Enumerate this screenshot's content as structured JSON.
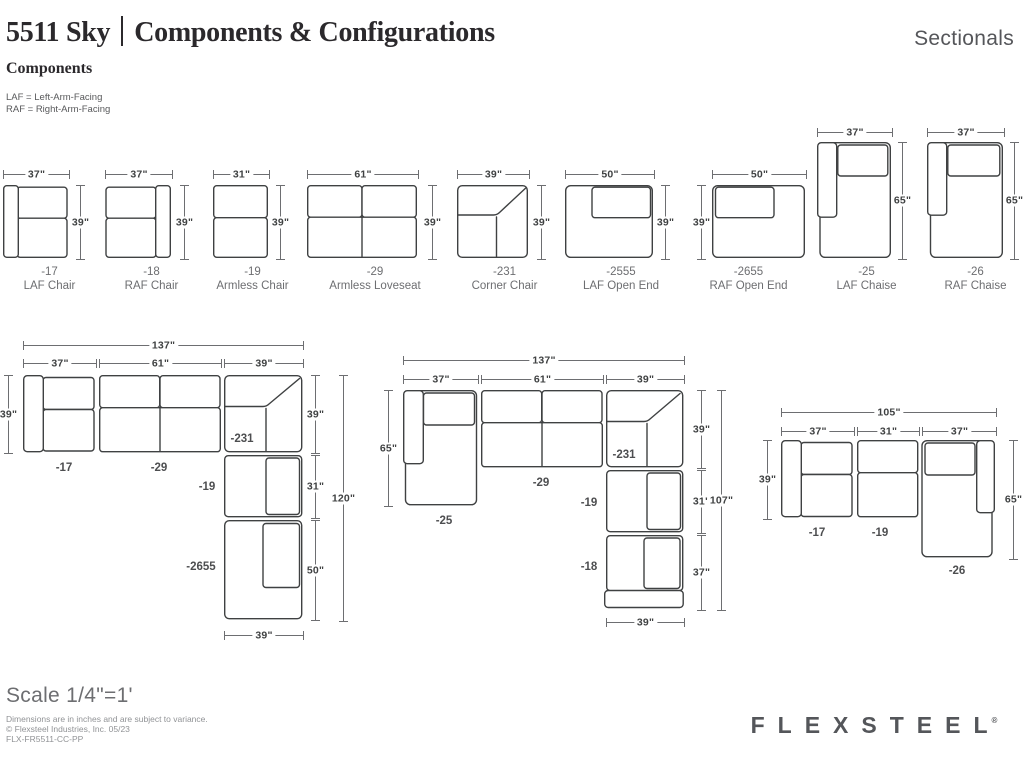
{
  "colors": {
    "line": "#3f4142",
    "dim_line": "#6d6e71",
    "label_text": "#414042",
    "muted_text": "#6d6e71",
    "footer_text": "#919396",
    "brand_text": "#54565a"
  },
  "header": {
    "model": "5511 Sky",
    "title": "Components & Configurations",
    "category": "Sectionals",
    "section_heading": "Components",
    "legend_laf": "LAF = Left-Arm-Facing",
    "legend_raf": "RAF = Right-Arm-Facing"
  },
  "components": [
    {
      "code": "-17",
      "name": "LAF Chair",
      "w": "37\"",
      "h": "39\""
    },
    {
      "code": "-18",
      "name": "RAF Chair",
      "w": "37\"",
      "h": "39\""
    },
    {
      "code": "-19",
      "name": "Armless Chair",
      "w": "31\"",
      "h": "39\""
    },
    {
      "code": "-29",
      "name": "Armless Loveseat",
      "w": "61\"",
      "h": "39\""
    },
    {
      "code": "-231",
      "name": "Corner Chair",
      "w": "39\"",
      "h": "39\""
    },
    {
      "code": "-2555",
      "name": "LAF Open End",
      "w": "50\"",
      "h": "39\""
    },
    {
      "code": "-2655",
      "name": "RAF Open End",
      "w": "50\"",
      "h": "39\""
    },
    {
      "code": "-25",
      "name": "LAF Chaise",
      "w": "37\"",
      "h": "65\""
    },
    {
      "code": "-26",
      "name": "RAF Chaise",
      "w": "37\"",
      "h": "65\""
    }
  ],
  "configurations": [
    {
      "total_w": "137\"",
      "segments": [
        "37\"",
        "61\"",
        "39\""
      ],
      "left_h": "39\"",
      "right_heights": [
        "39\"",
        "31\"",
        "50\""
      ],
      "total_h": "120\"",
      "bottom_w": "39\"",
      "pieces": [
        "-17",
        "-29",
        "-231",
        "-19",
        "-2655"
      ]
    },
    {
      "total_w": "137\"",
      "segments": [
        "37\"",
        "61\"",
        "39\""
      ],
      "left_h": "65\"",
      "right_heights": [
        "39\"",
        "31\"",
        "37\""
      ],
      "total_h": "107\"",
      "bottom_w": "39\"",
      "pieces": [
        "-25",
        "-29",
        "-231",
        "-19",
        "-18"
      ]
    },
    {
      "total_w": "105\"",
      "segments": [
        "37\"",
        "31\"",
        "37\""
      ],
      "left_h": "39\"",
      "right_h": "65\"",
      "pieces": [
        "-17",
        "-19",
        "-26"
      ]
    }
  ],
  "footer": {
    "scale": "Scale 1/4\"=1'",
    "line1": "Dimensions are in inches and are subject to variance.",
    "line2": "© Flexsteel Industries, Inc. 05/23",
    "line3": "FLX-FR5511-CC-PP",
    "logo": "FLEXSTEEL",
    "registered": "®"
  }
}
